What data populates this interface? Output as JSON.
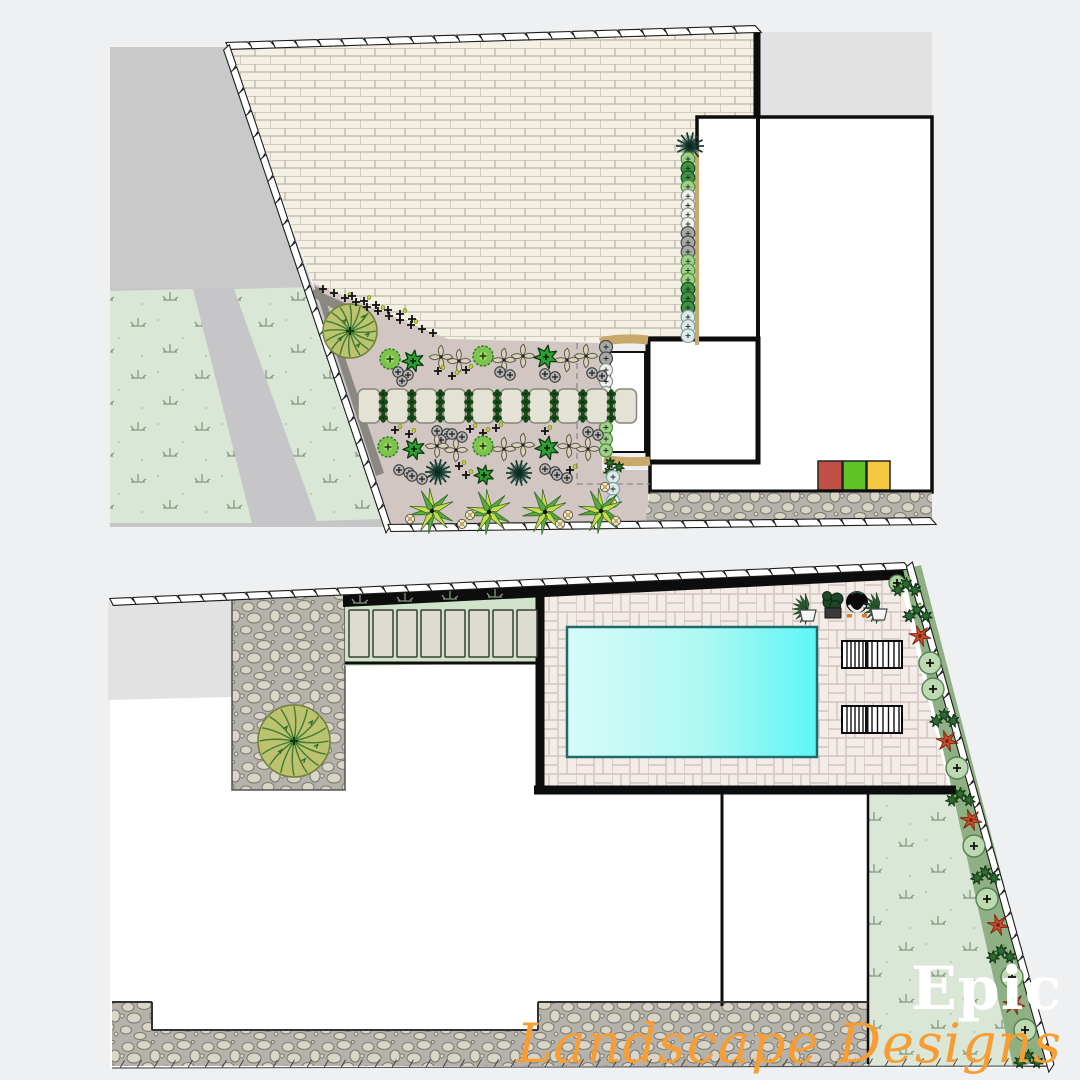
{
  "watermark": {
    "line1": "Epic",
    "line2": "Landscape Designs",
    "line1_color": "#ffffff",
    "line2_color": "#f79d33"
  },
  "palette": {
    "page_bg": "#eff0f1",
    "white": "#ffffff",
    "driveway": "#c9c9ca",
    "pathgray": "#c6c6c8",
    "lawn": "#dbe7d6",
    "lawn_symbol": "#84977f",
    "brick_fill": "#f4f0e3",
    "brick_line": "#b7b3a7",
    "bed": "#d2c6c2",
    "bed_dark": "#8b8781",
    "neighbor": "#e2e2e2",
    "stone_base": "#b4b2aa",
    "stone_fill": "#d9d6c8",
    "patio_fill": "#f3ece8",
    "patio_line": "#d2c5bd",
    "pool_light": "#d7fbf7",
    "pool_bright": "#5ef5f5",
    "pool_edge": "#1f6b6b",
    "wall": "#0d0d0d",
    "tan": "#c8a96a",
    "strip_green": "#8fb085",
    "paver_green": "#cfe3c9",
    "red_flower": "#cc4e2d",
    "bin_red": "#c05048",
    "bin_green": "#5ec327",
    "bin_yellow": "#f5c842"
  },
  "top_plan": {
    "label": "front-yard planting plan",
    "areas": [
      {
        "name": "driveway",
        "fill": "driveway",
        "points": "110,47 226,47 313,287 110,287"
      },
      {
        "name": "side-path",
        "fill": "pathgray",
        "points": "110,287 313,287 400,527 110,527"
      },
      {
        "name": "lawn-left",
        "fill": "lawn",
        "points": "110,291 193,289 252,523 110,523"
      },
      {
        "name": "lawn-right",
        "fill": "lawn",
        "points": "234,289 311,287 384,519 317,521"
      },
      {
        "name": "brick-paving",
        "fill": "brick",
        "points": "226,47 756,30 756,118 697,118 697,343 448,339 313,283"
      },
      {
        "name": "planting-bed",
        "fill": "bed",
        "points": "313,283 448,339 602,343 602,470 648,470 648,522 392,524"
      },
      {
        "name": "bed-edge-dark",
        "fill": "bed_dark",
        "points": "314,286 322,289 384,473 376,476"
      },
      {
        "name": "bed-edge-wedge",
        "fill": "bed_dark",
        "points": "313,289 352,306 344,315 313,297"
      },
      {
        "name": "neighbor-building",
        "fill": "neighbor",
        "points": "760,32 932,32 932,117 760,117"
      },
      {
        "name": "house-footprint",
        "fill": "white",
        "points": "697,117 932,117 932,492 650,492 650,462 648,462 648,339 697,339",
        "stroke": "#0d0d0d",
        "sw": 3.5
      },
      {
        "name": "garden-room",
        "fill": "white",
        "points": "648,339 758,339 758,462 648,462",
        "stroke": "#0d0d0d",
        "sw": 5
      },
      {
        "name": "stone-paving-strip",
        "fill": "stone",
        "points": "650,492 932,492 932,524 645,524"
      },
      {
        "name": "bin-red",
        "fill": "#c05048",
        "rect": [
          818,
          461,
          24,
          29
        ],
        "stroke": "#222",
        "sw": 1.5
      },
      {
        "name": "bin-green",
        "fill": "#5ec327",
        "rect": [
          843,
          461,
          23,
          29
        ],
        "stroke": "#222",
        "sw": 1.5
      },
      {
        "name": "bin-yellow",
        "fill": "#f5c842",
        "rect": [
          867,
          461,
          23,
          29
        ],
        "stroke": "#222",
        "sw": 1.5
      }
    ],
    "lines": [
      {
        "name": "party-wall",
        "d": "M757 30 L757 118",
        "stroke": "wall",
        "w": 7
      },
      {
        "name": "house-inner-wall",
        "d": "M758 118 L758 461",
        "stroke": "wall",
        "w": 4
      },
      {
        "name": "stone-strip-wall",
        "d": "M650 491 L932 491",
        "stroke": "wall",
        "w": 3
      },
      {
        "name": "bed-dashed-v",
        "d": "M577 343 L577 484",
        "stroke": "dash",
        "w": 1.3
      },
      {
        "name": "bed-dashed-h",
        "d": "M577 484 L650 484",
        "stroke": "dash",
        "w": 1.3
      },
      {
        "name": "planter-tan-top",
        "d": "M600 342 Q622 337 648 340",
        "stroke": "tan",
        "w": 9
      },
      {
        "name": "planter-tan-bottom",
        "d": "M604 459 Q626 463 650 461",
        "stroke": "tan",
        "w": 9
      },
      {
        "name": "hedge-tan-edge",
        "d": "M697 150 L697 345",
        "stroke": "tan",
        "w": 4
      }
    ],
    "fences": [
      {
        "name": "boundary-fence-top",
        "style": "panel",
        "p1": [
          226,
          46
        ],
        "p2": [
          757,
          29
        ]
      },
      {
        "name": "boundary-fence-left",
        "style": "panel",
        "p1": [
          226,
          46
        ],
        "p2": [
          388,
          528
        ]
      },
      {
        "name": "boundary-fence-bottom",
        "style": "panel",
        "p1": [
          388,
          528
        ],
        "p2": [
          932,
          521
        ]
      }
    ],
    "plants": [
      {
        "type": "whiterect",
        "x": 610,
        "y": 352,
        "w": 35,
        "h": 100
      },
      {
        "type": "agave",
        "x": 350,
        "y": 331,
        "r": 27
      },
      {
        "type": "spiky",
        "x": 690,
        "y": 146,
        "r": 14
      },
      {
        "type": "hedge_col",
        "x": 688,
        "y": 159,
        "step": 9.3,
        "r": 6.8,
        "colors": [
          "lt",
          "dk",
          "dk",
          "lt",
          "wh",
          "wh",
          "wh",
          "wh",
          "gr",
          "gr",
          "gr",
          "lt",
          "lt",
          "lt",
          "dk",
          "dk",
          "dk",
          "pb",
          "pb",
          "pb"
        ]
      },
      {
        "type": "hedge_col",
        "x": 606,
        "y": 347,
        "step": 11.5,
        "r": 6.5,
        "colors": [
          "gr",
          "gr",
          "wh",
          "wh",
          "wh",
          "pb",
          "pb",
          "lt",
          "lt",
          "lt"
        ]
      },
      {
        "type": "trio",
        "x": 610,
        "y": 463
      },
      {
        "type": "hedge_col",
        "x": 613,
        "y": 477,
        "step": 12,
        "r": 6.5,
        "colors": [
          "pb",
          "pb",
          "pb"
        ]
      },
      {
        "type": "yellowdot",
        "x": 605,
        "y": 487
      },
      {
        "type": "yellowdot",
        "x": 612,
        "y": 503
      },
      {
        "type": "cross",
        "x": 323,
        "y": 289
      },
      {
        "type": "cross",
        "x": 334,
        "y": 293
      },
      {
        "type": "crossdot",
        "x": 345,
        "y": 298
      },
      {
        "type": "cross",
        "x": 356,
        "y": 302
      },
      {
        "type": "cross",
        "x": 367,
        "y": 307
      },
      {
        "type": "crossdot",
        "x": 378,
        "y": 311
      },
      {
        "type": "cross",
        "x": 389,
        "y": 316
      },
      {
        "type": "cross",
        "x": 400,
        "y": 320
      },
      {
        "type": "crossdot",
        "x": 411,
        "y": 325
      },
      {
        "type": "cross",
        "x": 422,
        "y": 329
      },
      {
        "type": "cross",
        "x": 433,
        "y": 333
      },
      {
        "type": "cross",
        "x": 352,
        "y": 296
      },
      {
        "type": "crossdot",
        "x": 364,
        "y": 301
      },
      {
        "type": "cross",
        "x": 376,
        "y": 305
      },
      {
        "type": "cross",
        "x": 388,
        "y": 310
      },
      {
        "type": "crossdot",
        "x": 400,
        "y": 314
      },
      {
        "type": "cross",
        "x": 412,
        "y": 319
      },
      {
        "type": "circle_lg",
        "x": 390,
        "y": 359
      },
      {
        "type": "shrub",
        "x": 413,
        "y": 361,
        "r": 11
      },
      {
        "type": "beige",
        "x": 441,
        "y": 357
      },
      {
        "type": "beige",
        "x": 459,
        "y": 361
      },
      {
        "type": "circle_lg",
        "x": 483,
        "y": 356
      },
      {
        "type": "beige",
        "x": 504,
        "y": 360
      },
      {
        "type": "beige",
        "x": 523,
        "y": 356
      },
      {
        "type": "shrub",
        "x": 546,
        "y": 357,
        "r": 12
      },
      {
        "type": "beige",
        "x": 567,
        "y": 360
      },
      {
        "type": "beige",
        "x": 586,
        "y": 356
      },
      {
        "type": "gray",
        "x": 398,
        "y": 372,
        "n": 3
      },
      {
        "type": "crossdot",
        "x": 438,
        "y": 371
      },
      {
        "type": "crossdot",
        "x": 452,
        "y": 376
      },
      {
        "type": "crossdot",
        "x": 466,
        "y": 370
      },
      {
        "type": "gray",
        "x": 500,
        "y": 372,
        "n": 2
      },
      {
        "type": "gray",
        "x": 545,
        "y": 374,
        "n": 2
      },
      {
        "type": "gray",
        "x": 592,
        "y": 373,
        "n": 2
      },
      {
        "type": "stone_row",
        "x0": 358,
        "y": 389,
        "count": 10,
        "step": 28.5,
        "w": 22,
        "h": 34
      },
      {
        "type": "crossdot",
        "x": 395,
        "y": 430
      },
      {
        "type": "crossdot",
        "x": 409,
        "y": 434
      },
      {
        "type": "gray",
        "x": 437,
        "y": 431,
        "n": 3
      },
      {
        "type": "gray",
        "x": 452,
        "y": 434,
        "n": 2
      },
      {
        "type": "crossdot",
        "x": 470,
        "y": 429
      },
      {
        "type": "crossdot",
        "x": 483,
        "y": 433
      },
      {
        "type": "crossdot",
        "x": 496,
        "y": 428
      },
      {
        "type": "crossdot",
        "x": 545,
        "y": 431
      },
      {
        "type": "gray",
        "x": 588,
        "y": 432,
        "n": 2
      },
      {
        "type": "circle_lg",
        "x": 388,
        "y": 447
      },
      {
        "type": "shrub",
        "x": 414,
        "y": 449,
        "r": 11
      },
      {
        "type": "beige",
        "x": 437,
        "y": 446
      },
      {
        "type": "beige",
        "x": 456,
        "y": 450
      },
      {
        "type": "circle_lg",
        "x": 483,
        "y": 446
      },
      {
        "type": "beige",
        "x": 504,
        "y": 449
      },
      {
        "type": "beige",
        "x": 523,
        "y": 445
      },
      {
        "type": "shrub",
        "x": 547,
        "y": 448,
        "r": 12
      },
      {
        "type": "beige",
        "x": 569,
        "y": 446
      },
      {
        "type": "beige",
        "x": 588,
        "y": 449
      },
      {
        "type": "gray",
        "x": 399,
        "y": 470,
        "n": 2
      },
      {
        "type": "gray",
        "x": 412,
        "y": 476,
        "n": 2
      },
      {
        "type": "spiky",
        "x": 438,
        "y": 472,
        "r": 13
      },
      {
        "type": "crossdot",
        "x": 459,
        "y": 466
      },
      {
        "type": "crossdot",
        "x": 466,
        "y": 475
      },
      {
        "type": "shrub",
        "x": 484,
        "y": 475,
        "r": 10
      },
      {
        "type": "spiky",
        "x": 519,
        "y": 473,
        "r": 13
      },
      {
        "type": "gray",
        "x": 545,
        "y": 469,
        "n": 2
      },
      {
        "type": "gray",
        "x": 557,
        "y": 475,
        "n": 2
      },
      {
        "type": "crossdot",
        "x": 570,
        "y": 470
      },
      {
        "type": "palm",
        "x": 432,
        "y": 511,
        "r": 23
      },
      {
        "type": "palm",
        "x": 489,
        "y": 512,
        "r": 23
      },
      {
        "type": "palm",
        "x": 545,
        "y": 512,
        "r": 23
      },
      {
        "type": "palm",
        "x": 601,
        "y": 511,
        "r": 23
      },
      {
        "type": "yellowdot",
        "x": 410,
        "y": 519
      },
      {
        "type": "yellowdot",
        "x": 462,
        "y": 524
      },
      {
        "type": "yellowdot",
        "x": 470,
        "y": 515
      },
      {
        "type": "yellowdot",
        "x": 560,
        "y": 524
      },
      {
        "type": "yellowdot",
        "x": 568,
        "y": 515
      },
      {
        "type": "yellowdot",
        "x": 616,
        "y": 521
      }
    ]
  },
  "bottom_plan": {
    "label": "rear-yard pool plan",
    "areas": [
      {
        "name": "plot-base",
        "fill": "white",
        "points": "110,604 906,566 921,564 1050,1064 1013,1068 110,1068"
      },
      {
        "name": "neighbor-building",
        "fill": "neighbor",
        "points": "108,601 232,597 232,697 108,700"
      },
      {
        "name": "stone-court",
        "fill": "stone",
        "points": "232,597 345,592 345,790 232,790",
        "stroke": "#55534e",
        "sw": 1.5
      },
      {
        "name": "paver-lawn-strip",
        "fill": "paver_green",
        "points": "345,592 540,584 540,663 345,666"
      },
      {
        "name": "pool-patio",
        "fill": "patio",
        "points": "540,584 897,569 950,792 540,792"
      },
      {
        "name": "boundary-wall-band",
        "fill": "wall",
        "points": "343,594 910,568 910,579 343,607"
      },
      {
        "name": "pool",
        "fill": "pool",
        "points": "567,627 817,627 817,757 567,757",
        "stroke": "#1f6b6b",
        "sw": 2.5
      },
      {
        "name": "lawn-rear",
        "fill": "lawn",
        "points": "868,794 952,794 1020,1066 868,1066"
      },
      {
        "name": "side-planting-strip",
        "fill": "strip_green",
        "points": "903,569 921,565 1050,1062 1013,1066"
      },
      {
        "name": "stone-paving-bottom",
        "fill": "stone",
        "points": "112,1002 152,1002 152,1030 538,1030 538,1002 868,1002 868,1066 112,1066"
      }
    ],
    "lines": [
      {
        "name": "patio-wall-left",
        "d": "M540 588 L540 792",
        "stroke": "wall",
        "w": 9
      },
      {
        "name": "patio-wall-bottom",
        "d": "M534 790 L956 790",
        "stroke": "wall",
        "w": 9
      },
      {
        "name": "strip-wall-bottom",
        "d": "M345 663 L540 663",
        "stroke": "wall",
        "w": 3
      },
      {
        "name": "house-inner-wall",
        "d": "M722 792 L722 1006",
        "stroke": "wall",
        "w": 3
      },
      {
        "name": "lawn-wall-left",
        "d": "M868 794 L868 1064",
        "stroke": "wall",
        "w": 2.5
      },
      {
        "name": "stone-edge-1",
        "d": "M112 1002 L152 1002",
        "stroke": "dark",
        "w": 2
      },
      {
        "name": "stone-edge-2",
        "d": "M152 1002 L152 1030",
        "stroke": "dark",
        "w": 2
      },
      {
        "name": "stone-edge-3",
        "d": "M152 1030 L538 1030",
        "stroke": "dark",
        "w": 2
      },
      {
        "name": "stone-edge-4",
        "d": "M538 1002 L538 1030",
        "stroke": "dark",
        "w": 2
      },
      {
        "name": "stone-edge-5",
        "d": "M538 1002 L868 1002",
        "stroke": "dark",
        "w": 2
      }
    ],
    "fences": [
      {
        "name": "boundary-fence-top",
        "style": "panel",
        "p1": [
          110,
          602
        ],
        "p2": [
          906,
          566
        ]
      },
      {
        "name": "boundary-fence-right",
        "style": "panel",
        "p1": [
          909,
          563
        ],
        "p2": [
          1051,
          1067
        ]
      },
      {
        "name": "boundary-fence-bottom",
        "style": "hatch",
        "p1": [
          112,
          1068
        ],
        "p2": [
          1048,
          1066
        ]
      }
    ],
    "plants": [
      {
        "type": "agave",
        "x": 294,
        "y": 741,
        "r": 36
      },
      {
        "type": "paver_row",
        "x0": 349,
        "y": 610,
        "count": 8,
        "step": 24,
        "w": 20,
        "h": 47
      },
      {
        "type": "tuft",
        "x": 360,
        "y": 603
      },
      {
        "type": "tuft",
        "x": 405,
        "y": 601
      },
      {
        "type": "tuft",
        "x": 450,
        "y": 599
      },
      {
        "type": "tuft",
        "x": 495,
        "y": 597
      },
      {
        "type": "lounger",
        "x": 842,
        "y": 641
      },
      {
        "type": "lounger",
        "x": 842,
        "y": 706
      },
      {
        "type": "plantA",
        "x": 808,
        "y": 607
      },
      {
        "type": "plantB",
        "x": 833,
        "y": 604
      },
      {
        "type": "planterC",
        "x": 857,
        "y": 602
      },
      {
        "type": "plantA",
        "x": 879,
        "y": 606
      },
      {
        "type": "circle_sm",
        "x": 897,
        "y": 583
      },
      {
        "type": "strip_dk",
        "x": 906,
        "y": 584
      },
      {
        "type": "strip_dk",
        "x": 917,
        "y": 610
      },
      {
        "type": "red",
        "x": 920,
        "y": 636
      },
      {
        "type": "strip_lt",
        "x": 930,
        "y": 663
      },
      {
        "type": "strip_lt",
        "x": 933,
        "y": 689
      },
      {
        "type": "strip_dk",
        "x": 944,
        "y": 715
      },
      {
        "type": "red",
        "x": 947,
        "y": 741
      },
      {
        "type": "strip_lt",
        "x": 957,
        "y": 768
      },
      {
        "type": "strip_dk",
        "x": 960,
        "y": 794
      },
      {
        "type": "red",
        "x": 971,
        "y": 820
      },
      {
        "type": "strip_lt",
        "x": 974,
        "y": 846
      },
      {
        "type": "strip_dk",
        "x": 985,
        "y": 872
      },
      {
        "type": "strip_lt",
        "x": 987,
        "y": 899
      },
      {
        "type": "red",
        "x": 998,
        "y": 925
      },
      {
        "type": "strip_dk",
        "x": 1001,
        "y": 951
      },
      {
        "type": "strip_lt",
        "x": 1012,
        "y": 977
      },
      {
        "type": "red",
        "x": 1014,
        "y": 1004
      },
      {
        "type": "strip_lt",
        "x": 1025,
        "y": 1030
      },
      {
        "type": "strip_dk",
        "x": 1028,
        "y": 1056
      }
    ]
  }
}
